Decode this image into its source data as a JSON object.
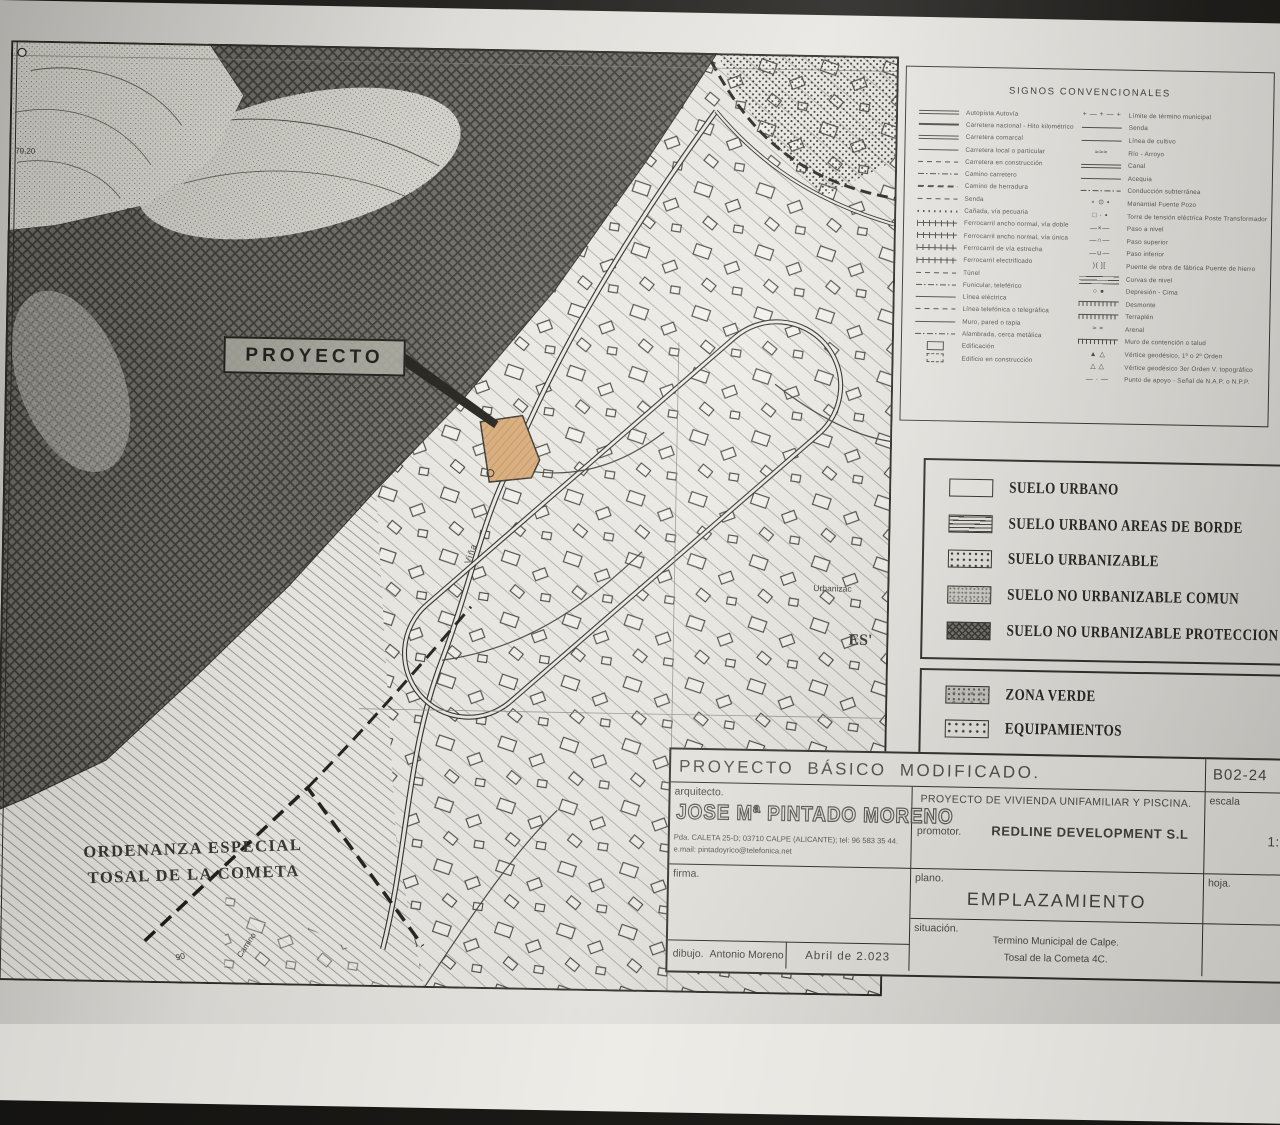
{
  "colors": {
    "parcel": "#d8a873",
    "paper": "#eeece7",
    "desk": "#17160f",
    "ink": "#2c2b25"
  },
  "plan": {
    "proyecto_label": "PROYECTO",
    "map_labels": {
      "ordenanza_line1": "ORDENANZA ESPECIAL",
      "ordenanza_line2": "TOSAL DE LA COMETA",
      "vina": "Viña",
      "urbaniza": "Urbanizac",
      "es": "ES'",
      "camino": "Camino",
      "elev_79": "79,20",
      "elev_90": "90",
      "fr": "Fr"
    }
  },
  "signos": {
    "title": "SIGNOS CONVENCIONALES",
    "left": [
      {
        "label": "Autopista Autovía",
        "sym": "double"
      },
      {
        "label": "Carretera nacional - Hito kilométrico",
        "sym": "thick"
      },
      {
        "label": "Carretera comarcal",
        "sym": "double"
      },
      {
        "label": "Carretera local o particular",
        "sym": "line"
      },
      {
        "label": "Carretera en construcción",
        "sym": "dash"
      },
      {
        "label": "Camino carretero",
        "sym": "dashdot"
      },
      {
        "label": "Camino de herradura",
        "sym": "dashthick"
      },
      {
        "label": "Senda",
        "sym": "dash"
      },
      {
        "label": "Cañada, vía pecuaria",
        "sym": "dots"
      },
      {
        "label": "Ferrocarril ancho normal, vía doble",
        "sym": "rail"
      },
      {
        "label": "Ferrocarril ancho normal, vía única",
        "sym": "rail"
      },
      {
        "label": "Ferrocarril de vía estrecha",
        "sym": "rail"
      },
      {
        "label": "Ferrocarril electrificado",
        "sym": "rail"
      },
      {
        "label": "Túnel",
        "sym": "dash"
      },
      {
        "label": "Funicular, teleférico",
        "sym": "dashdot"
      },
      {
        "label": "Línea eléctrica",
        "sym": "line"
      },
      {
        "label": "Línea telefónica o telegráfica",
        "sym": "dash"
      },
      {
        "label": "Muro, pared o tapia",
        "sym": "line"
      },
      {
        "label": "Alambrada, cerca metálica",
        "sym": "dashdot"
      },
      {
        "label": "Edificación",
        "sym": "rect"
      },
      {
        "label": "Edificio en construcción",
        "sym": "rectdash"
      }
    ],
    "right": [
      {
        "label": "Límite de término municipal",
        "sym": "glyph",
        "glyph": "+ — + — +"
      },
      {
        "label": "Senda",
        "sym": "line"
      },
      {
        "label": "Línea de cultivo",
        "sym": "line"
      },
      {
        "label": "Río - Arroyo",
        "sym": "glyph",
        "glyph": "≈≈≈"
      },
      {
        "label": "Canal",
        "sym": "double"
      },
      {
        "label": "Acequia",
        "sym": "line"
      },
      {
        "label": "Conducción subterránea",
        "sym": "dashdot"
      },
      {
        "label": "Manantial   Fuente   Pozo",
        "sym": "glyph",
        "glyph": "∘  ⊙  •"
      },
      {
        "label": "Torre de tensión eléctrica   Poste   Transformador",
        "sym": "glyph",
        "glyph": "□  ·  ▪"
      },
      {
        "label": "Paso a nivel",
        "sym": "glyph",
        "glyph": "—×—"
      },
      {
        "label": "Paso superior",
        "sym": "glyph",
        "glyph": "—∩—"
      },
      {
        "label": "Paso inferior",
        "sym": "glyph",
        "glyph": "—∪—"
      },
      {
        "label": "Puente de obra de fábrica   Puente de hierro",
        "sym": "glyph",
        "glyph": ")(   ]["
      },
      {
        "label": "Curvas de nivel",
        "sym": "levels"
      },
      {
        "label": "Depresión - Cima",
        "sym": "glyph",
        "glyph": "○ ●"
      },
      {
        "label": "Desmonte",
        "sym": "ticks"
      },
      {
        "label": "Terraplén",
        "sym": "ticks"
      },
      {
        "label": "Arenal",
        "sym": "glyph",
        "glyph": "≈ ≈"
      },
      {
        "label": "Muro de contención o talud",
        "sym": "ticks"
      },
      {
        "label": "Vértice geodésico, 1º o 2º Orden",
        "sym": "glyph",
        "glyph": "▲ △"
      },
      {
        "label": "Vértice geodésico 3er Orden   V. topográfico",
        "sym": "glyph",
        "glyph": "△ △"
      },
      {
        "label": "Punto de apoyo - Señal de N.A.P. o N.P.P.",
        "sym": "glyph",
        "glyph": "— · —"
      }
    ]
  },
  "suelo_legend": {
    "items": [
      {
        "label": "SUELO URBANO",
        "swatch": "plain"
      },
      {
        "label": "SUELO URBANO AREAS DE BORDE",
        "swatch": "hlines"
      },
      {
        "label": "SUELO URBANIZABLE",
        "swatch": "dotsw"
      },
      {
        "label": "SUELO NO URBANIZABLE COMUN",
        "swatch": "stipple"
      },
      {
        "label": "SUELO NO URBANIZABLE PROTECCION ESPECIAL",
        "swatch": "crosshatch"
      }
    ]
  },
  "zona_legend": {
    "items": [
      {
        "label": "ZONA VERDE",
        "swatch": "mottle"
      },
      {
        "label": "EQUIPAMIENTOS",
        "swatch": "dots2"
      }
    ]
  },
  "title_block": {
    "project_title": "PROYECTO  BÁSICO  MODIFICADO.",
    "code": "B02-24",
    "arquitecto_label": "arquitecto.",
    "arquitecto_name": "JOSE Mª PINTADO MORENO",
    "address": "Pda. CALETA 25-D; 03710 CALPE (ALICANTE); tel: 96 583 35 44.",
    "email": "e.mail: pintadoyrico@telefonica.net",
    "obra": "PROYECTO  DE  VIVIENDA  UNIFAMILIAR  Y  PISCINA.",
    "promotor_label": "promotor.",
    "promotor": "REDLINE  DEVELOPMENT  S.L",
    "escala_label": "escala",
    "escala": "1:2",
    "firma_label": "firma.",
    "plano_label": "plano.",
    "plano": "EMPLAZAMIENTO",
    "situacion_label": "situación.",
    "situacion_line1": "Termino  Municipal  de  Calpe.",
    "situacion_line2": "Tosal  de  la  Cometa  4C.",
    "hoja_label": "hoja.",
    "dibujo_label": "dibujo.",
    "dibujo": "Antonio Moreno",
    "fecha": "Abril  de  2.023"
  }
}
